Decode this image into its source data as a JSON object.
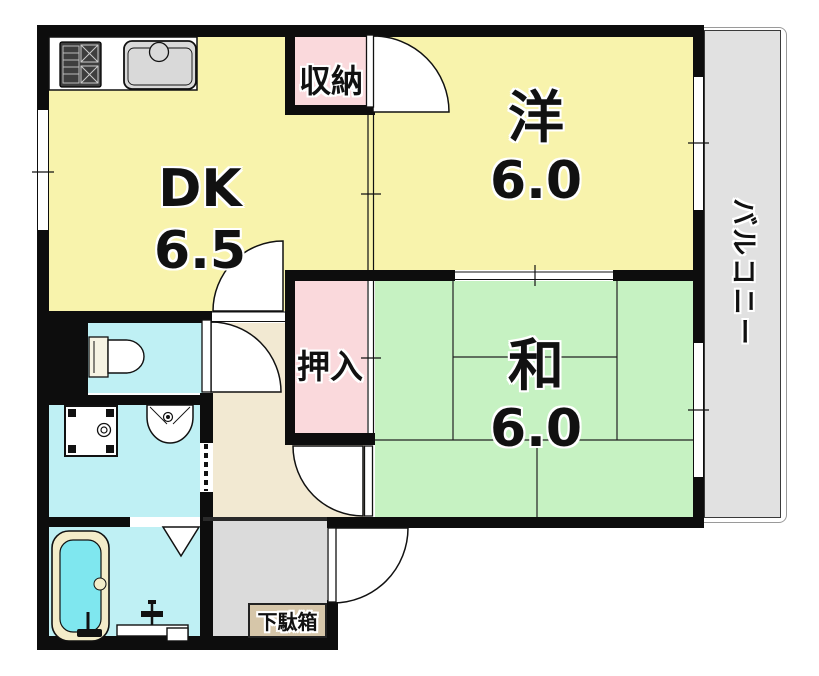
{
  "plan": {
    "title": "1DK apartment floor plan",
    "rooms": {
      "dk": {
        "label": "DK",
        "size": "6.5"
      },
      "western_room": {
        "label": "洋",
        "size": "6.0"
      },
      "japanese_room": {
        "label": "和",
        "size": "6.0"
      },
      "storage": {
        "label": "収納"
      },
      "closet": {
        "label": "押入"
      },
      "balcony": {
        "label": "バルコニー"
      },
      "shoe_cabinet": {
        "label": "下駄箱"
      }
    },
    "fixtures": [
      "gas-stove-icon",
      "kitchen-sink-icon",
      "toilet-icon",
      "washing-machine-pan-icon",
      "wash-basin-icon",
      "bathtub-icon",
      "folding-door-icon",
      "accordion-door-icon"
    ],
    "colors": {
      "room_yellow": "#F8F3AC",
      "tatami_green": "#C6F2C2",
      "closet_pink": "#FAD9DC",
      "wet_area_cyan": "#BFF0F4",
      "bath_water_cyan": "#7FE7EF",
      "hallway_beige": "#F2E9D2",
      "balcony_gray": "#E1E1E1",
      "entrance_gray": "#DBDBDB",
      "shoe_cabinet_tan": "#D6C6A9",
      "wall_black": "#0D0D0D"
    }
  }
}
